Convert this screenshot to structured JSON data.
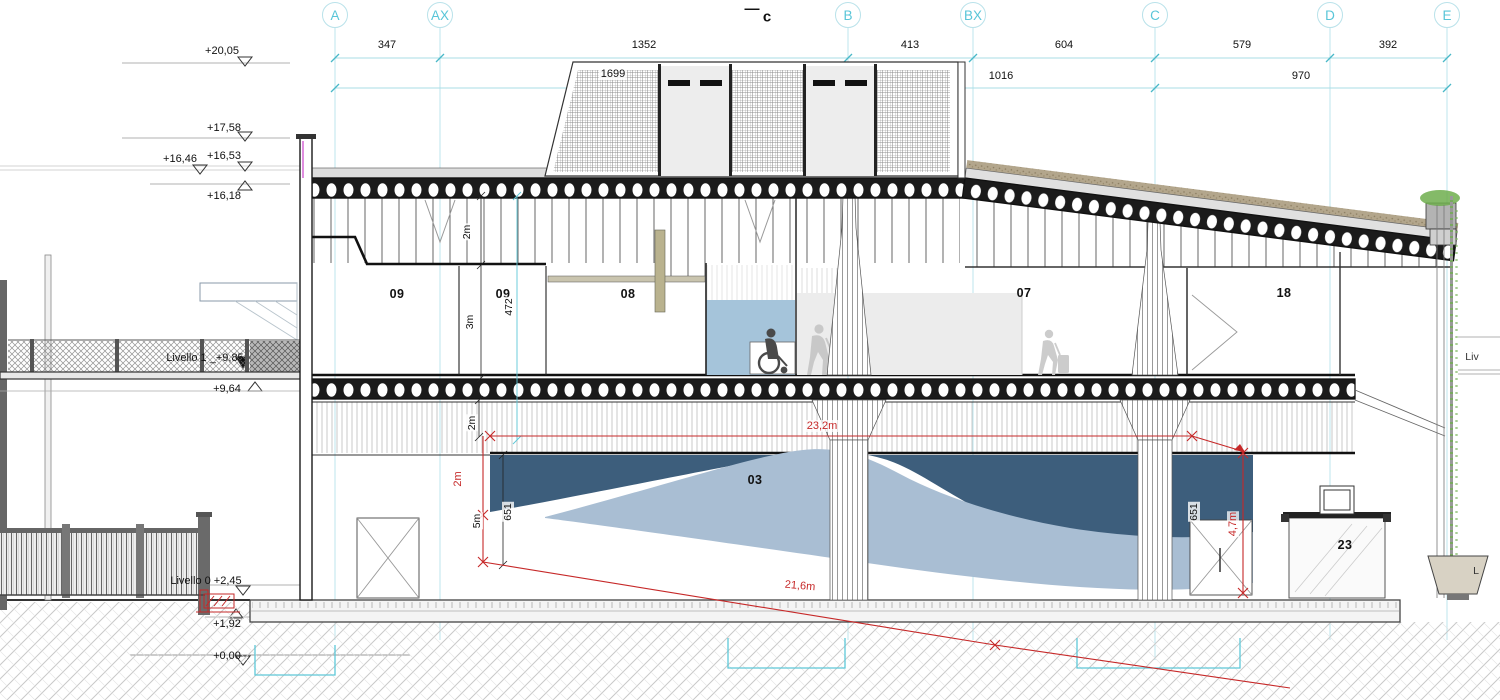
{
  "drawing": {
    "section_marker": {
      "dash": "—",
      "letter": "c"
    },
    "colors": {
      "grid_cyan": "#a8dde6",
      "bubble_text": "#58c5d8",
      "dim_red": "#c62828",
      "dark_blue_zone": "#3d5e7c",
      "light_blue_zone": "#a9bed3",
      "elevator_blue": "#a5c4da",
      "vegetation_green": "#6fae4e",
      "foundation_cyan": "#5ec8d8",
      "tan_wall": "#b9b28e"
    },
    "grid_bubbles": [
      {
        "label": "A",
        "x": 335
      },
      {
        "label": "AX",
        "x": 440
      },
      {
        "label": "B",
        "x": 848
      },
      {
        "label": "BX",
        "x": 973
      },
      {
        "label": "C",
        "x": 1155
      },
      {
        "label": "D",
        "x": 1330
      },
      {
        "label": "E",
        "x": 1447
      }
    ],
    "labels": {
      "row1": [
        {
          "t": "347",
          "x": 387,
          "y": 45
        },
        {
          "t": "1352",
          "x": 644,
          "y": 45
        },
        {
          "t": "413",
          "x": 910,
          "y": 45
        },
        {
          "t": "604",
          "x": 1064,
          "y": 45
        },
        {
          "t": "579",
          "x": 1242,
          "y": 45
        },
        {
          "t": "392",
          "x": 1388,
          "y": 45
        }
      ],
      "row2": [
        {
          "t": "1699",
          "x": 613,
          "y": 74
        },
        {
          "t": "1016",
          "x": 1001,
          "y": 76
        },
        {
          "t": "970",
          "x": 1301,
          "y": 76
        }
      ],
      "section": [
        {
          "t": "—",
          "x": 752,
          "y": 9
        },
        {
          "t": "c",
          "x": 767,
          "y": 17
        }
      ],
      "elevations": [
        {
          "t": "+20,05",
          "x": 222,
          "y": 51
        },
        {
          "t": "+17,58",
          "x": 224,
          "y": 128
        },
        {
          "t": "+16,46",
          "x": 180,
          "y": 159
        },
        {
          "t": "+16,53",
          "x": 224,
          "y": 156
        },
        {
          "t": "+16,18",
          "x": 224,
          "y": 196
        },
        {
          "t": "Livello 1 _+9,85",
          "x": 205,
          "y": 358
        },
        {
          "t": "+9,64",
          "x": 227,
          "y": 389
        },
        {
          "t": "Livello 0  +2,45",
          "x": 206,
          "y": 581
        },
        {
          "t": "+1,92",
          "x": 227,
          "y": 624
        },
        {
          "t": "+0,00",
          "x": 227,
          "y": 656
        }
      ],
      "rooms": [
        {
          "t": "09",
          "x": 397,
          "y": 294
        },
        {
          "t": "09",
          "x": 503,
          "y": 294
        },
        {
          "t": "08",
          "x": 628,
          "y": 294
        },
        {
          "t": "07",
          "x": 1024,
          "y": 293
        },
        {
          "t": "18",
          "x": 1284,
          "y": 293
        },
        {
          "t": "03",
          "x": 755,
          "y": 480
        },
        {
          "t": "23",
          "x": 1345,
          "y": 545
        }
      ],
      "dims_black": [
        {
          "t": "2m",
          "x": 467,
          "y": 232,
          "r": -90
        },
        {
          "t": "472",
          "x": 509,
          "y": 307,
          "r": -90
        },
        {
          "t": "3m",
          "x": 470,
          "y": 322,
          "r": -90
        },
        {
          "t": "2m",
          "x": 472,
          "y": 423,
          "r": -90
        },
        {
          "t": "5m",
          "x": 477,
          "y": 521,
          "r": -90
        },
        {
          "t": "651",
          "x": 508,
          "y": 512,
          "r": -90
        },
        {
          "t": "651",
          "x": 1194,
          "y": 512,
          "r": -90
        }
      ],
      "dims_red": [
        {
          "t": "23,2m",
          "x": 822,
          "y": 426,
          "r": 0
        },
        {
          "t": "2m",
          "x": 458,
          "y": 479,
          "r": -90
        },
        {
          "t": "4,7m",
          "x": 1233,
          "y": 524,
          "r": -90
        },
        {
          "t": "21,6m",
          "x": 800,
          "y": 586,
          "r": 5
        }
      ],
      "side": [
        {
          "t": "Liv",
          "x": 1472,
          "y": 357
        },
        {
          "t": "L",
          "x": 1476,
          "y": 571
        }
      ]
    }
  }
}
